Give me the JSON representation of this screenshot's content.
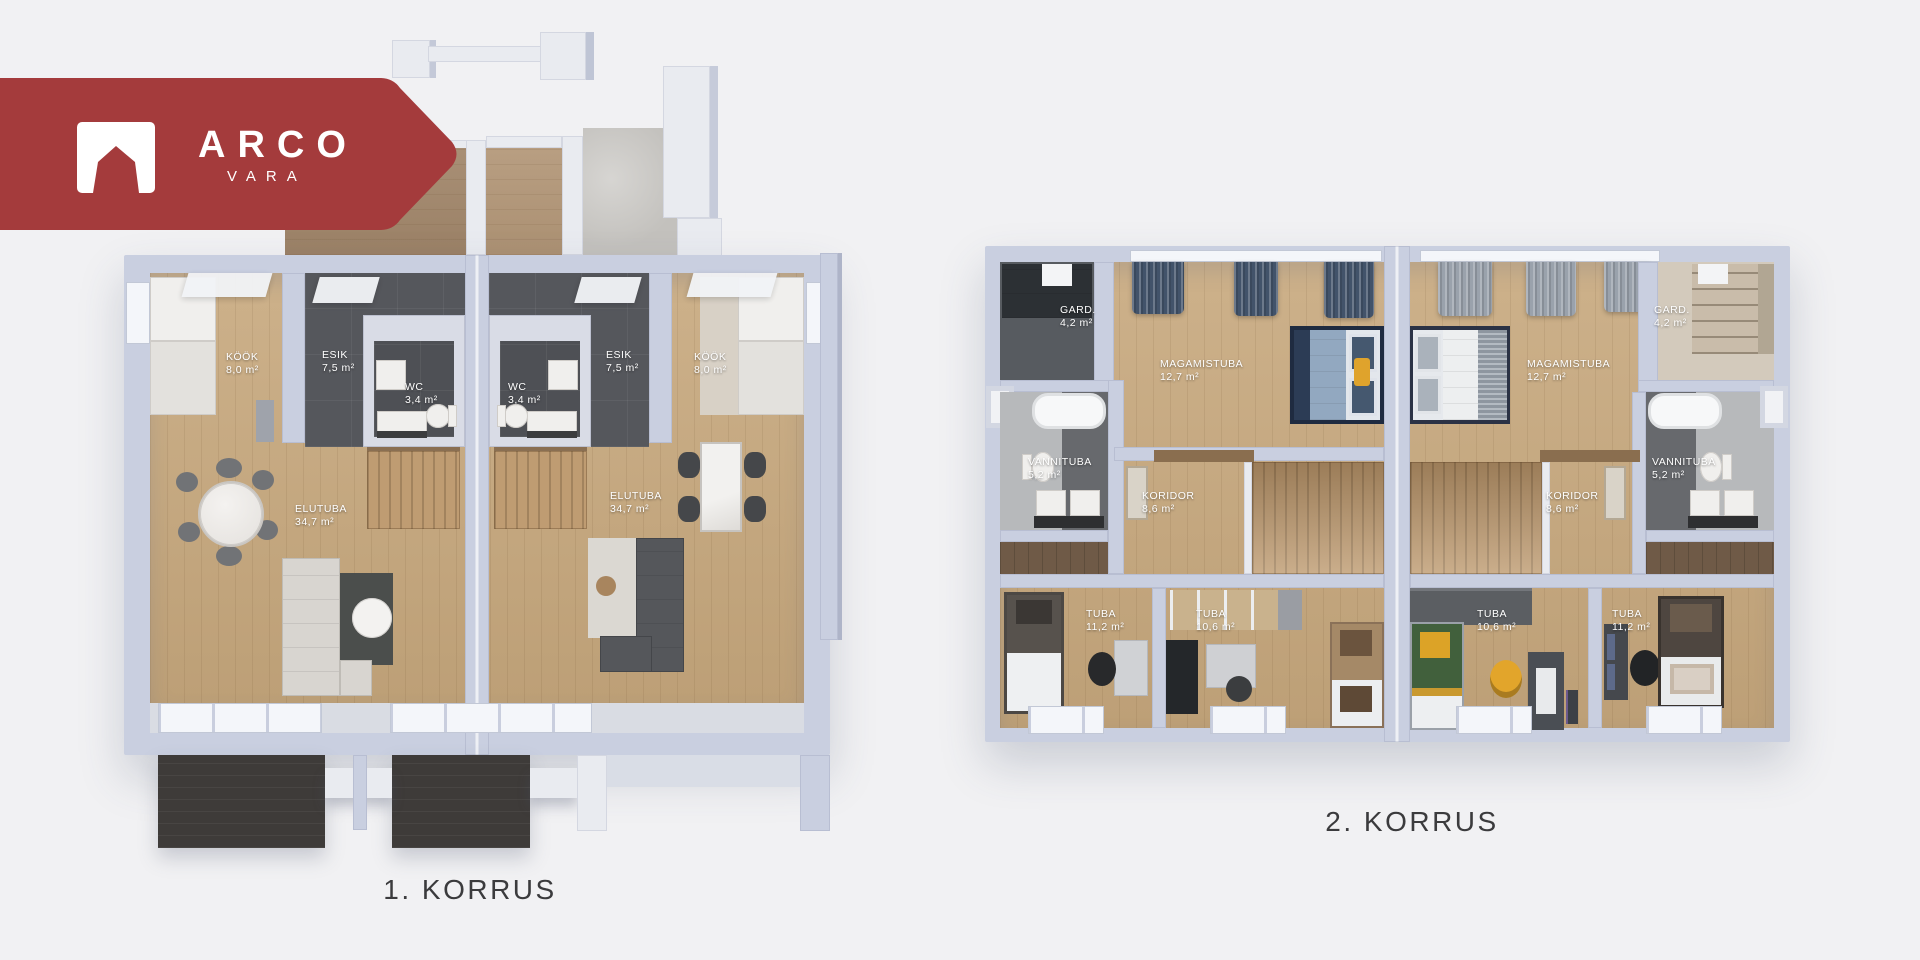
{
  "brand": {
    "name": "ARCO",
    "sub": "VARA",
    "logo_icon": "house-icon"
  },
  "floor1": {
    "title": "1. KORRUS",
    "left": {
      "kook": {
        "name": "KÖÖK",
        "area": "8,0 m²"
      },
      "esik": {
        "name": "ESIK",
        "area": "7,5 m²"
      },
      "wc": {
        "name": "WC",
        "area": "3,4 m²"
      },
      "elutuba": {
        "name": "ELUTUBA",
        "area": "34,7 m²"
      }
    },
    "right": {
      "kook": {
        "name": "KÖÖK",
        "area": "8,0 m²"
      },
      "esik": {
        "name": "ESIK",
        "area": "7,5 m²"
      },
      "wc": {
        "name": "WC",
        "area": "3,4 m²"
      },
      "elutuba": {
        "name": "ELUTUBA",
        "area": "34,7 m²"
      }
    }
  },
  "floor2": {
    "title": "2. KORRUS",
    "left": {
      "gard": {
        "name": "GARD.",
        "area": "4,2 m²"
      },
      "magamistuba": {
        "name": "MAGAMISTUBA",
        "area": "12,7 m²"
      },
      "vannituba": {
        "name": "VANNITUBA",
        "area": "5,2 m²"
      },
      "koridor": {
        "name": "KORIDOR",
        "area": "8,6 m²"
      },
      "tuba_large": {
        "name": "TUBA",
        "area": "11,2 m²"
      },
      "tuba_small": {
        "name": "TUBA",
        "area": "10,6 m²"
      }
    },
    "right": {
      "gard": {
        "name": "GARD.",
        "area": "4,2 m²"
      },
      "magamistuba": {
        "name": "MAGAMISTUBA",
        "area": "12,7 m²"
      },
      "vannituba": {
        "name": "VANNITUBA",
        "area": "5,2 m²"
      },
      "koridor": {
        "name": "KORIDOR",
        "area": "8,6 m²"
      },
      "tuba_large": {
        "name": "TUBA",
        "area": "11,2 m²"
      },
      "tuba_small": {
        "name": "TUBA",
        "area": "10,6 m²"
      }
    }
  },
  "colors": {
    "background": "#f1f1f3",
    "banner": "#a43b3c",
    "wall": "#c9cfe0",
    "wood": "#c7a87d",
    "dark_tile": "#55575c",
    "terrace": "#3e3b39",
    "label_text": "#ffffff",
    "title_text": "#3b3b3d",
    "bed_navy": "#92a8c0",
    "bed_green": "#41603c",
    "accent_yellow": "#dfa32c"
  }
}
